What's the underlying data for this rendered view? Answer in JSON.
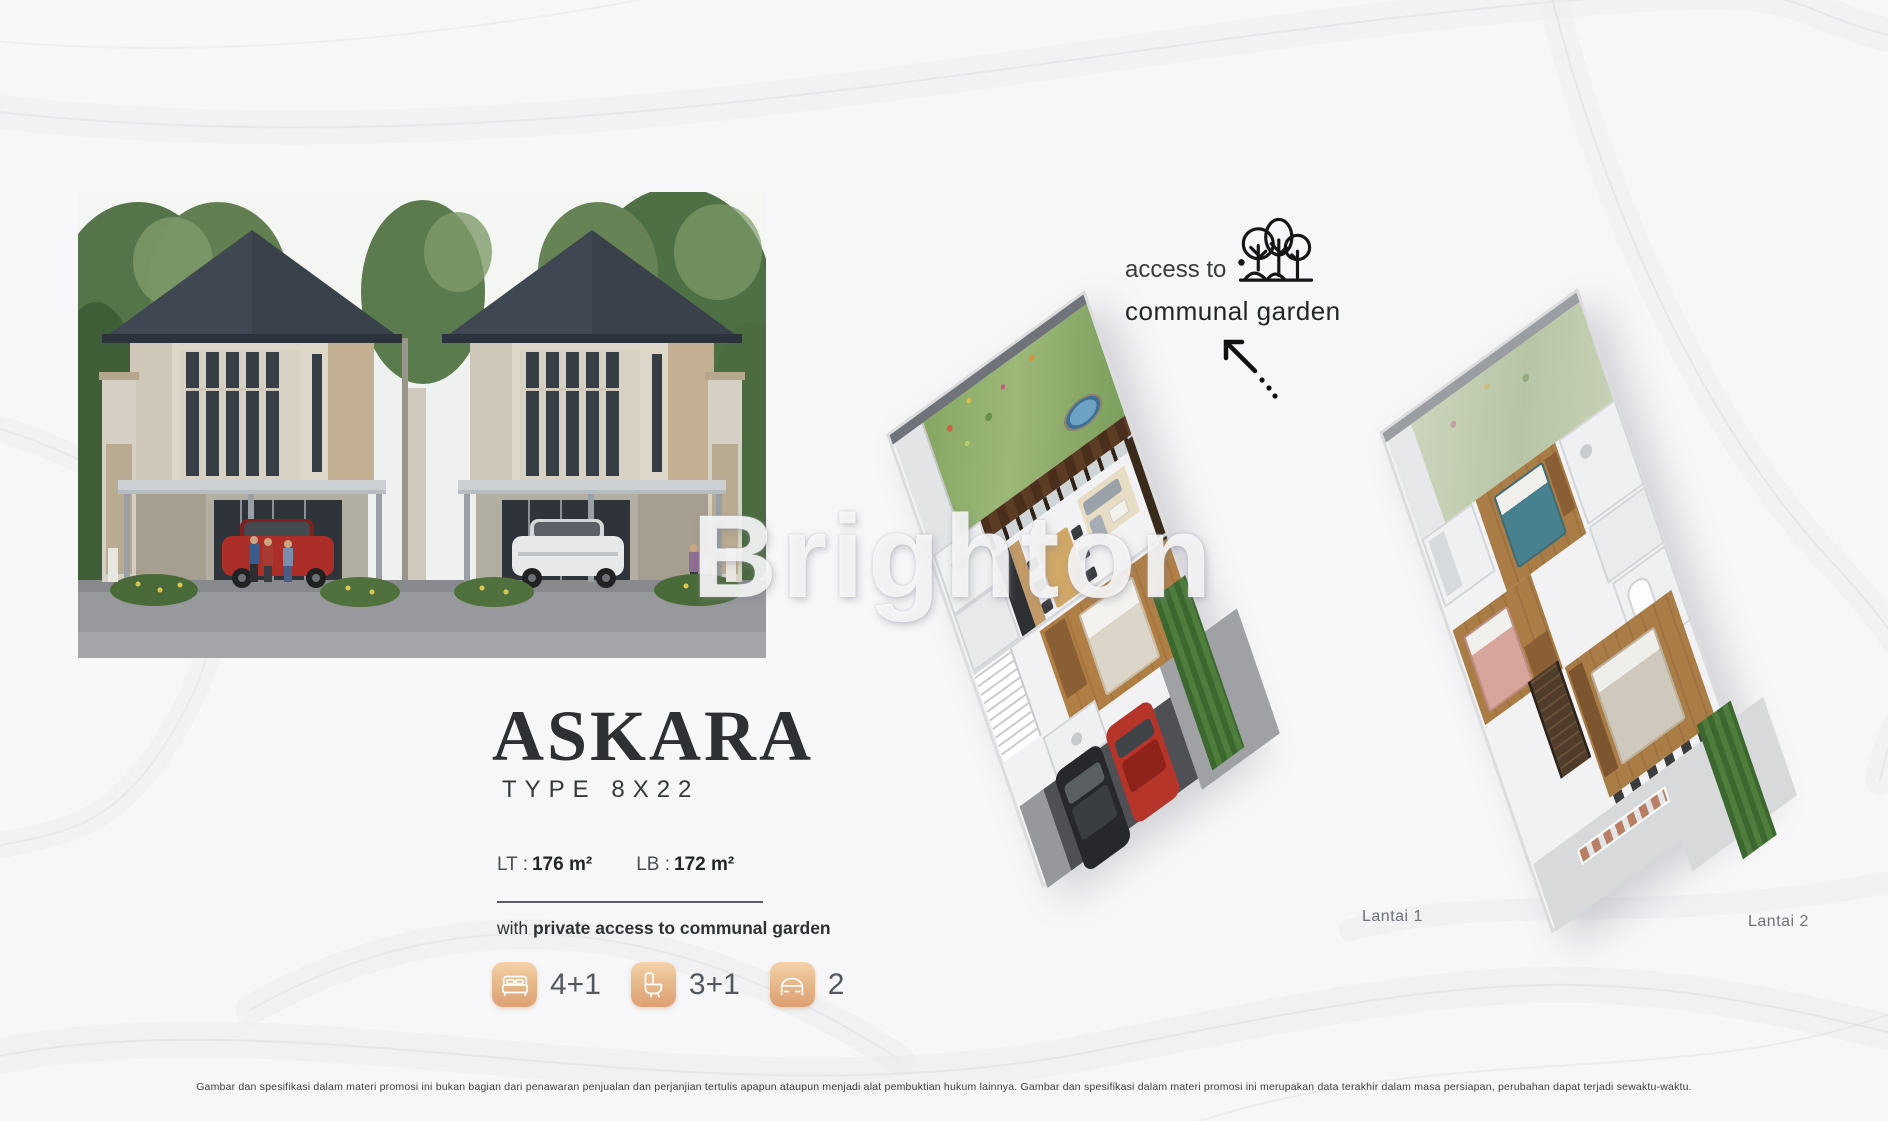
{
  "watermark": "Brighton",
  "product": {
    "name": "ASKARA",
    "type": "TYPE 8X22",
    "lt_label": "LT :",
    "lt_value": "176 m²",
    "lb_label": "LB :",
    "lb_value": "172 m²",
    "tagline_prefix": "with",
    "tagline_rest": "private access to communal garden"
  },
  "features": [
    {
      "name": "bedrooms",
      "icon": "bed-icon",
      "value": "4+1"
    },
    {
      "name": "bathrooms",
      "icon": "toilet-icon",
      "value": "3+1"
    },
    {
      "name": "carport",
      "icon": "car-icon",
      "value": "2"
    }
  ],
  "garden_callout": {
    "line1": "access to",
    "line2": "communal garden",
    "icon": "trees-icon",
    "arrow_icon": "arrow-up-left-icon"
  },
  "floorplans": [
    {
      "label": "Lantai 1"
    },
    {
      "label": "Lantai 2"
    }
  ],
  "disclaimer": "Gambar dan spesifikasi dalam materi promosi ini bukan bagian dari penawaran penjualan dan perjanjian tertulis apapun ataupun menjadi alat pembuktian hukum lainnya. Gambar dan spesifikasi dalam materi promosi ini merupakan data terakhir dalam masa persiapan, perubahan dapat terjadi sewaktu-waktu.",
  "colors": {
    "title": "#2e3034",
    "icon_tile_top": "#f5d2aa",
    "icon_tile_bottom": "#dda074",
    "background": "#f7f7f9",
    "plan_garden_green": "#8aa968",
    "car_red": "#b5352b"
  }
}
